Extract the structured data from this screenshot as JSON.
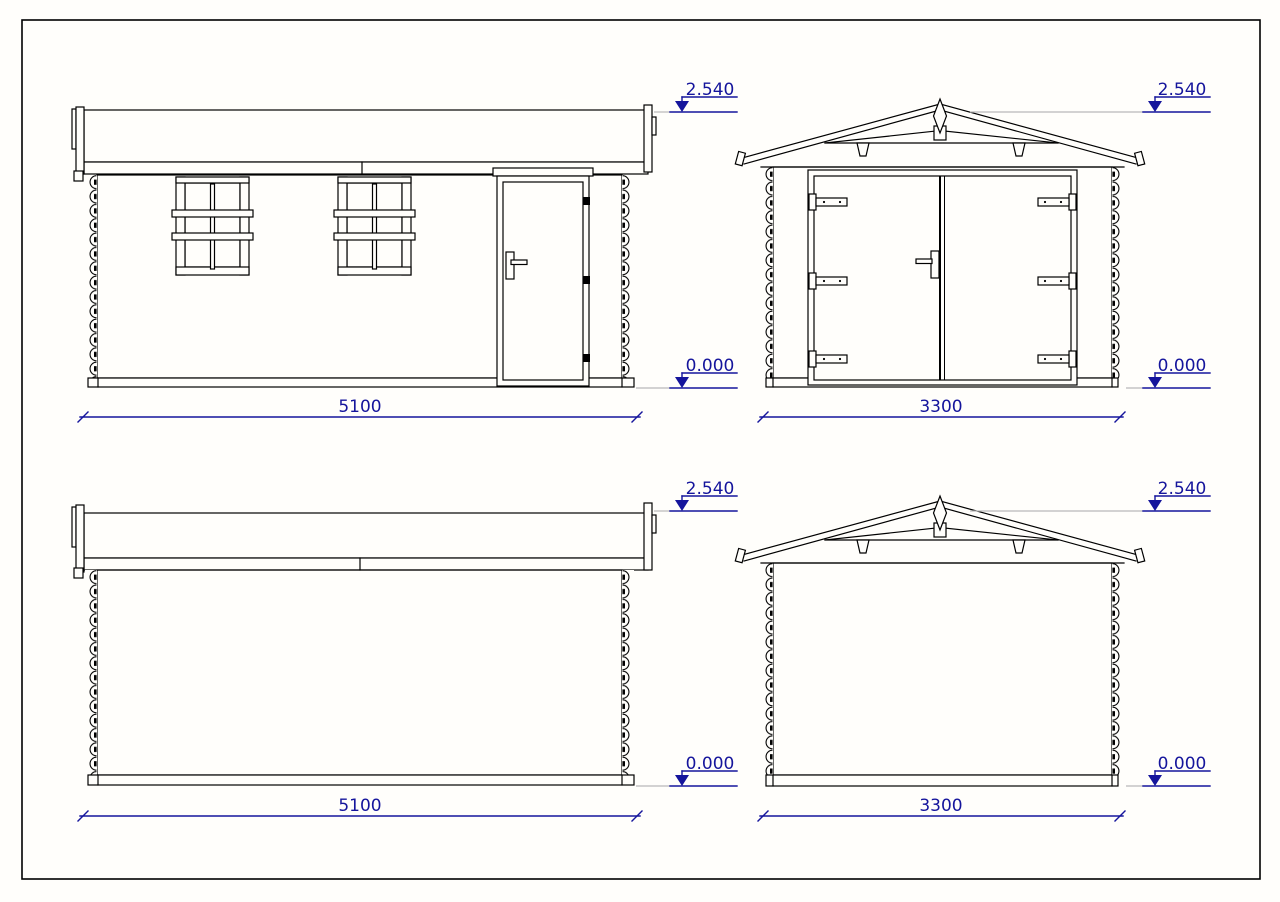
{
  "drawing": {
    "type": "elevation-plan",
    "colors": {
      "line": "#000000",
      "dimension_accent": "#15159c",
      "reference_gray": "#b9b9b9",
      "paper": "#fffefb"
    },
    "views": [
      {
        "id": "side-elevation-a",
        "dimension_label": "5100",
        "levels": {
          "top": "2.540",
          "ground": "0.000"
        }
      },
      {
        "id": "front-elevation",
        "dimension_label": "3300",
        "levels": {
          "top": "2.540",
          "ground": "0.000"
        }
      },
      {
        "id": "side-elevation-b",
        "dimension_label": "5100",
        "levels": {
          "top": "2.540",
          "ground": "0.000"
        }
      },
      {
        "id": "rear-elevation",
        "dimension_label": "3300",
        "levels": {
          "top": "2.540",
          "ground": "0.000"
        }
      }
    ]
  }
}
